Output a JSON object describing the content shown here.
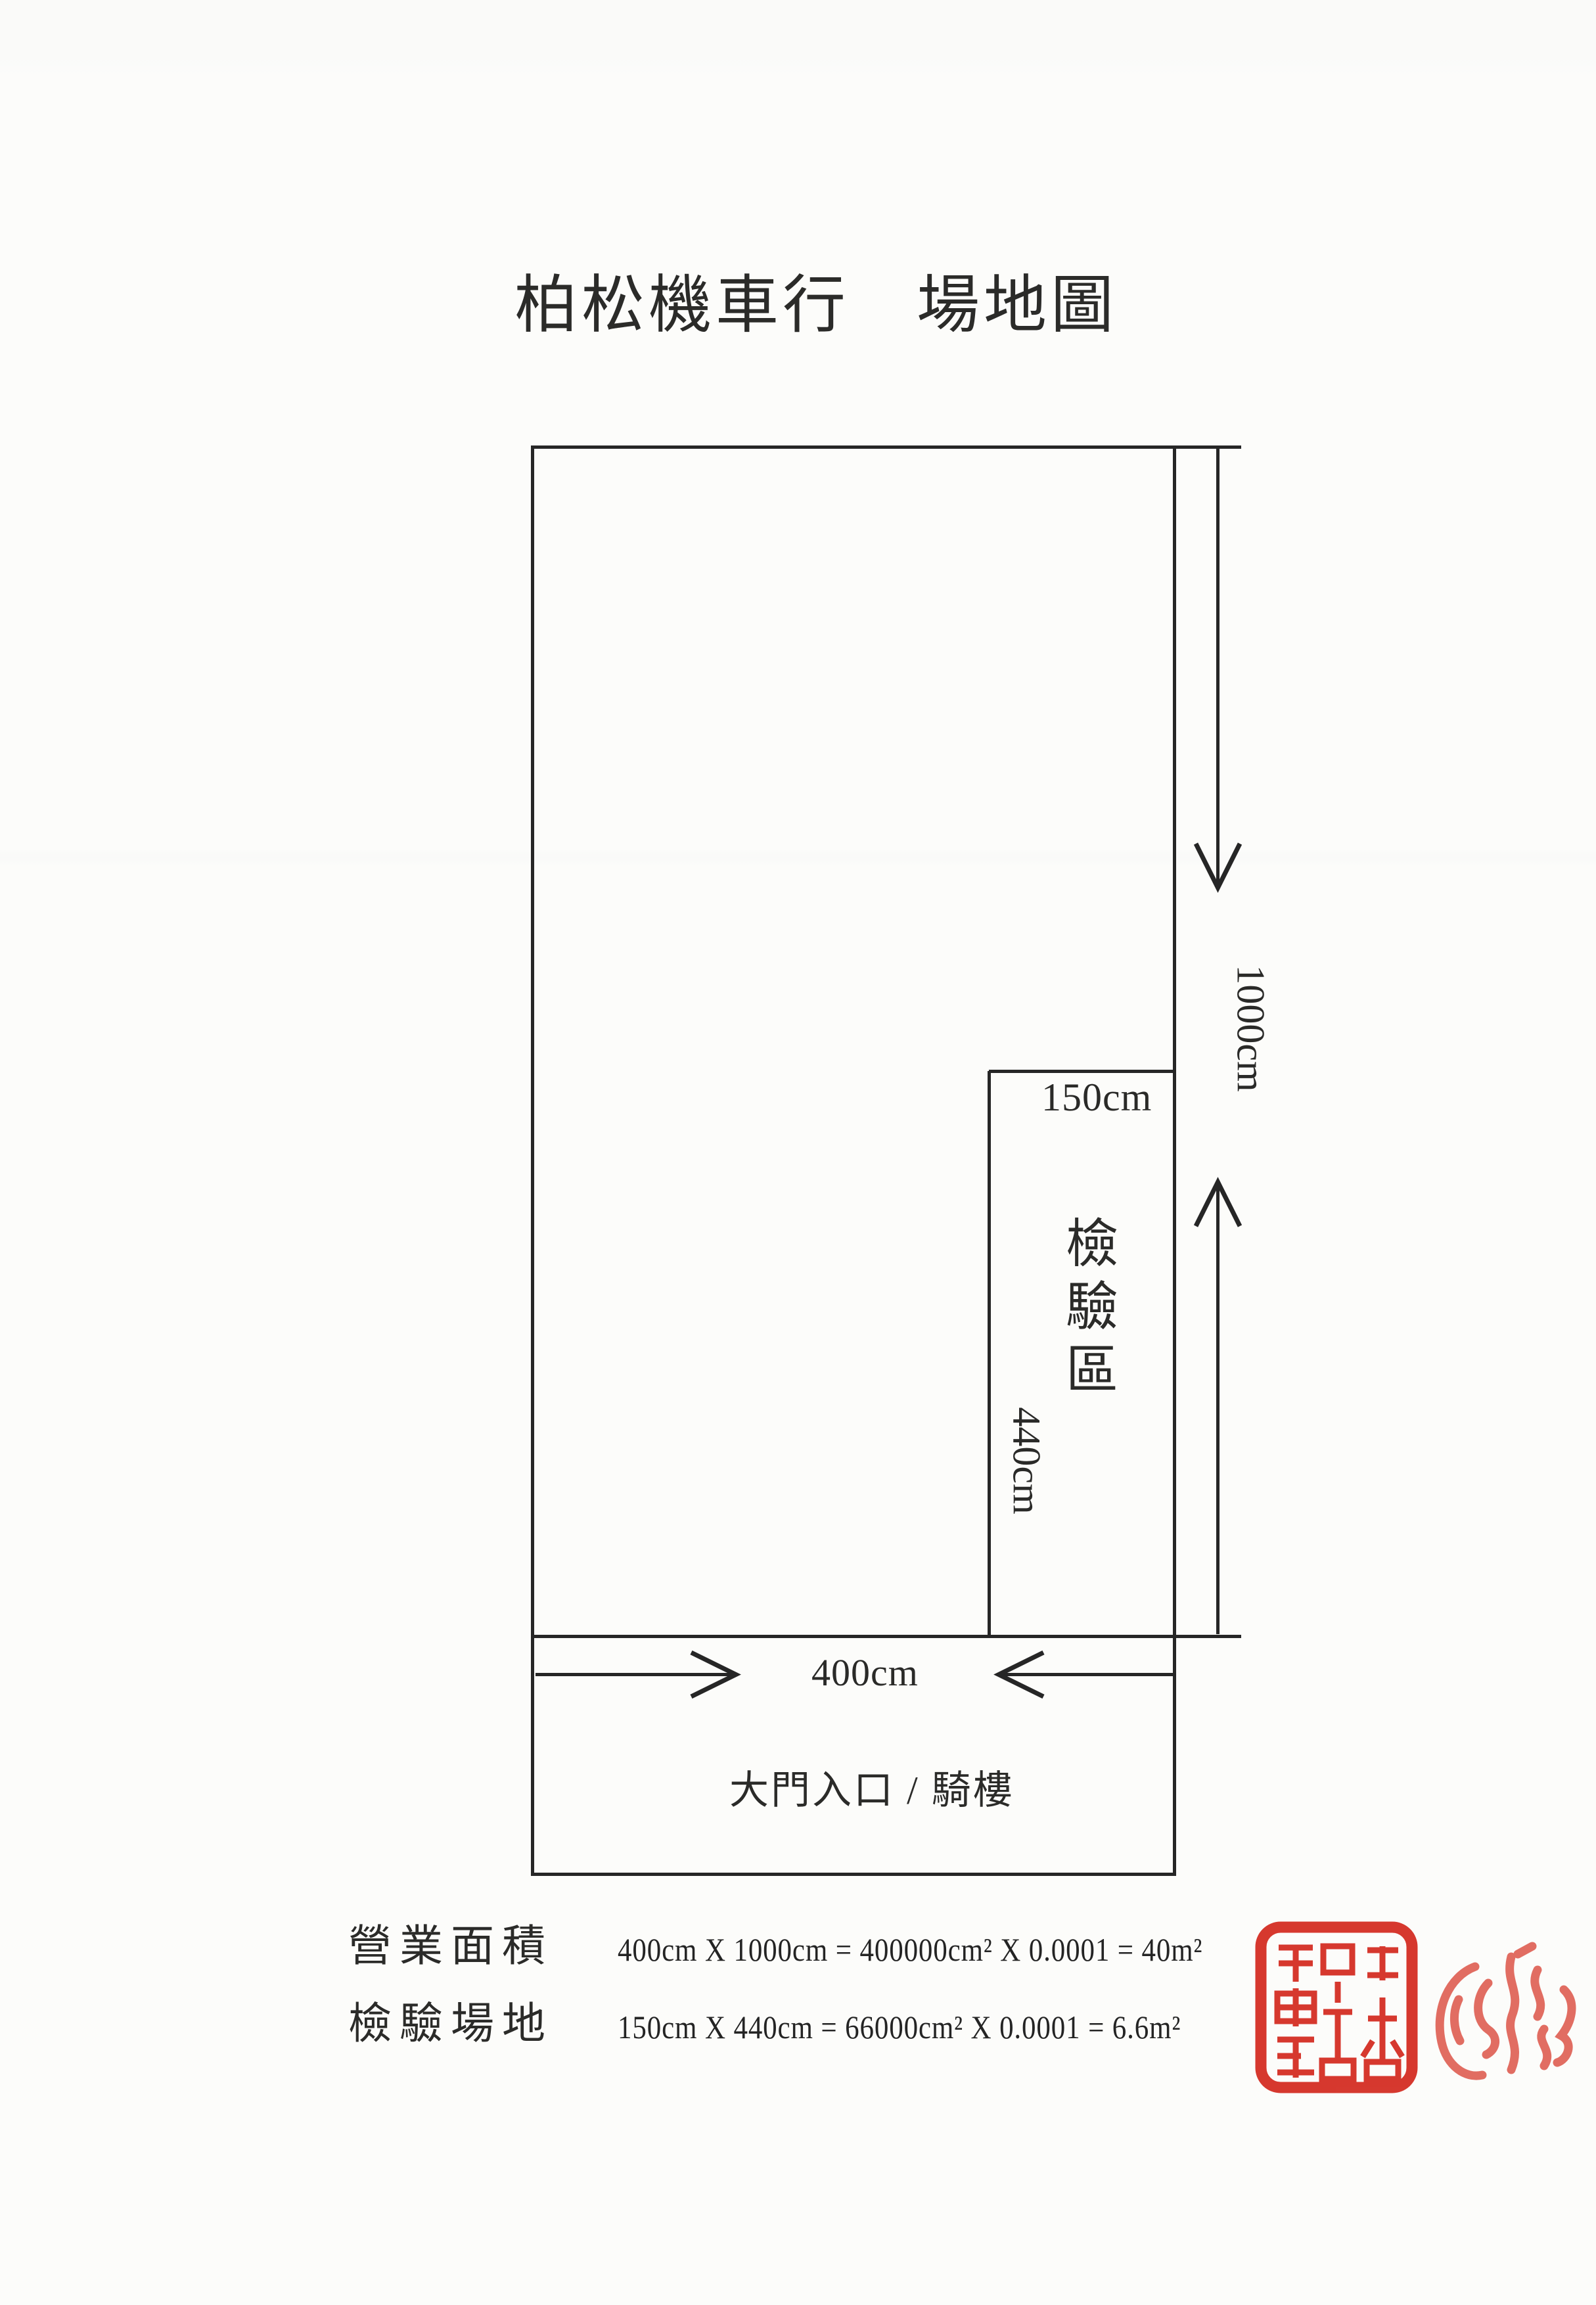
{
  "title": "柏松機車行　場地圖",
  "plan": {
    "height_label": "1000cm",
    "width_label": "400cm",
    "inspection_width_label": "150cm",
    "inspection_height_label": "440cm",
    "inspection_area_label": "檢驗區",
    "entrance_label": "大門入口 / 騎樓"
  },
  "calculations": {
    "business_area": {
      "label": "營業面積",
      "formula": "400cm X 1000cm = 400000cm² X 0.0001 = 40m²"
    },
    "inspection_site": {
      "label": "檢驗場地",
      "formula": "150cm X 440cm = 66000cm² X 0.0001 = 6.6m²"
    }
  },
  "icons": {
    "company_seal": "red-square-company-seal-stamp",
    "signature_seal": "red-round-signature-seal-stamp",
    "dim_height_arrows": "inward-pointing-vertical-dimension-arrows",
    "dim_width_arrows": "inward-pointing-horizontal-dimension-arrows"
  },
  "colors": {
    "ink": "#262626",
    "paper": "#fcfcfa",
    "seal_red": "#d3281d",
    "signature_red": "#da4638"
  }
}
